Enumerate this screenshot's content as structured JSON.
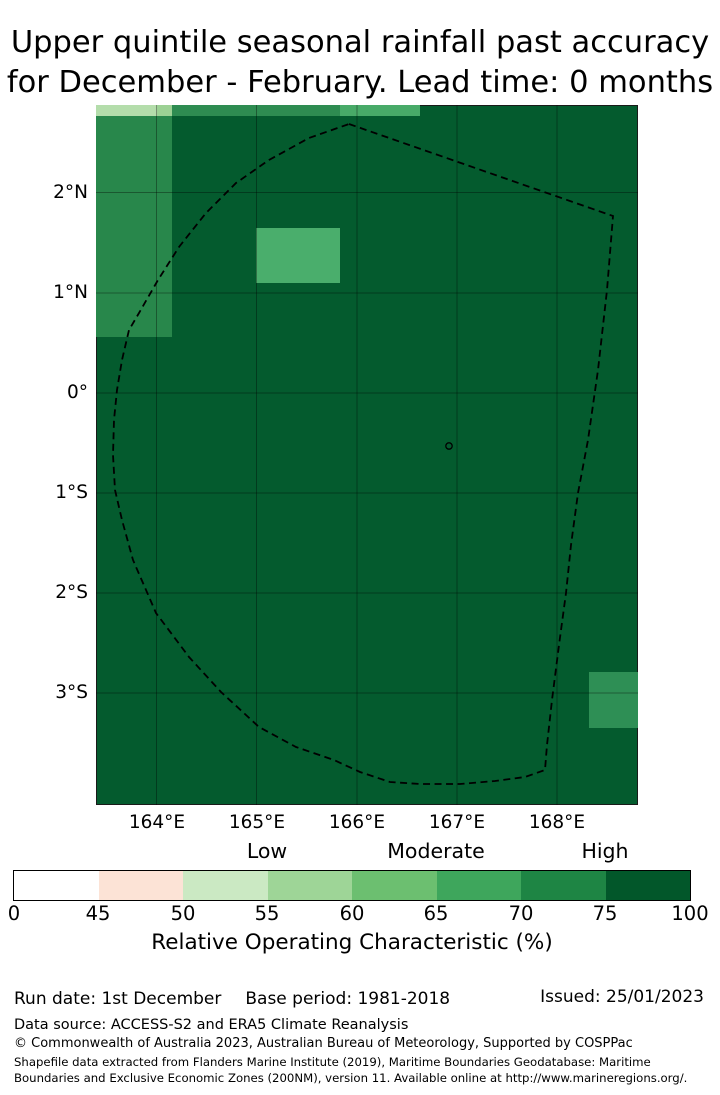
{
  "title": {
    "line1": "Upper quintile seasonal rainfall past accuracy",
    "line2": "for December - February. Lead time: 0 months"
  },
  "map": {
    "lat_ticks": [
      "2°N",
      "1°N",
      "0°",
      "1°S",
      "2°S",
      "3°S"
    ],
    "lon_ticks": [
      "164°E",
      "165°E",
      "166°E",
      "167°E",
      "168°E"
    ]
  },
  "legend": {
    "category_labels": [
      "Low",
      "Moderate",
      "High"
    ],
    "ticks": [
      "0",
      "45",
      "50",
      "55",
      "60",
      "65",
      "70",
      "75",
      "100"
    ],
    "segment_colors": [
      "#ffffff",
      "#fce3d6",
      "#cbe9c3",
      "#9ed597",
      "#6cbf70",
      "#3ea65c",
      "#1e8544",
      "#02572a"
    ],
    "axis_label": "Relative Operating Characteristic (%)"
  },
  "footer": {
    "run_date": "Run date: 1st December",
    "base_period": "Base period: 1981-2018",
    "issued": "Issued: 25/01/2023",
    "data_source": "Data source: ACCESS-S2 and ERA5 Climate Reanalysis",
    "copyright": "© Commonwealth of Australia 2023, Australian Bureau of Meteorology, Supported by COSPPac",
    "shapefile_note": "Shapefile data extracted from Flanders Marine Institute (2019), Maritime Boundaries Geodatabase: Maritime Boundaries and Exclusive Economic Zones (200NM), version 11. Available online at http://www.marineregions.org/."
  },
  "chart_data": {
    "type": "heatmap",
    "title": "Upper quintile seasonal rainfall past accuracy for December - February. Lead time: 0 months",
    "xlabel": "Longitude",
    "ylabel": "Latitude",
    "x_ticks": [
      "164°E",
      "165°E",
      "166°E",
      "167°E",
      "168°E"
    ],
    "y_ticks": [
      "2°N",
      "1°N",
      "0°",
      "1°S",
      "2°S",
      "3°S"
    ],
    "x_range_deg_east": [
      163.4,
      168.8
    ],
    "y_range_deg": [
      -4.1,
      2.9
    ],
    "colorbar": {
      "label": "Relative Operating Characteristic (%)",
      "tick_values": [
        0,
        45,
        50,
        55,
        60,
        65,
        70,
        75,
        100
      ],
      "segment_colors": [
        "#ffffff",
        "#fce3d6",
        "#cbe9c3",
        "#9ed597",
        "#6cbf70",
        "#3ea65c",
        "#1e8544",
        "#02572a"
      ],
      "category_labels": [
        "Low",
        "Moderate",
        "High"
      ],
      "category_centers": [
        55,
        65,
        75
      ]
    },
    "background_color": "#045b2e",
    "background_roc_class": "75-100",
    "regions": [
      {
        "name": "northwest-cell-pale-a",
        "roc_class": "55-60",
        "color": "#b4ddab",
        "approx_extent": {
          "lon": [
            163.4,
            164.0
          ],
          "lat": [
            2.75,
            2.9
          ]
        }
      },
      {
        "name": "northwest-cell-pale-b",
        "roc_class": "55-60",
        "color": "#9cd194",
        "approx_extent": {
          "lon": [
            164.0,
            164.17
          ],
          "lat": [
            2.75,
            2.9
          ]
        }
      },
      {
        "name": "north-strip-west",
        "roc_class": "70-75",
        "color": "#2e8c51",
        "approx_extent": {
          "lon": [
            164.17,
            165.85
          ],
          "lat": [
            2.75,
            2.9
          ]
        }
      },
      {
        "name": "north-strip-east",
        "roc_class": "65-70",
        "color": "#48aa68",
        "approx_extent": {
          "lon": [
            165.85,
            166.67
          ],
          "lat": [
            2.75,
            2.9
          ]
        }
      },
      {
        "name": "west-column",
        "roc_class": "70-75",
        "color": "#28874b",
        "approx_extent": {
          "lon": [
            163.4,
            164.17
          ],
          "lat": [
            0.55,
            2.75
          ]
        }
      },
      {
        "name": "central-cell",
        "roc_class": "65-70",
        "color": "#4aae6c",
        "approx_extent": {
          "lon": [
            165.0,
            165.83
          ],
          "lat": [
            1.1,
            1.65
          ]
        }
      },
      {
        "name": "southeast-cell",
        "roc_class": "70-75",
        "color": "#2e8f55",
        "approx_extent": {
          "lon": [
            168.33,
            168.8
          ],
          "lat": [
            -3.35,
            -2.8
          ]
        }
      }
    ],
    "overlays": {
      "boundary": "dashed EEZ (200NM) boundary polygon",
      "marker": "small circle outline (island location)"
    }
  }
}
